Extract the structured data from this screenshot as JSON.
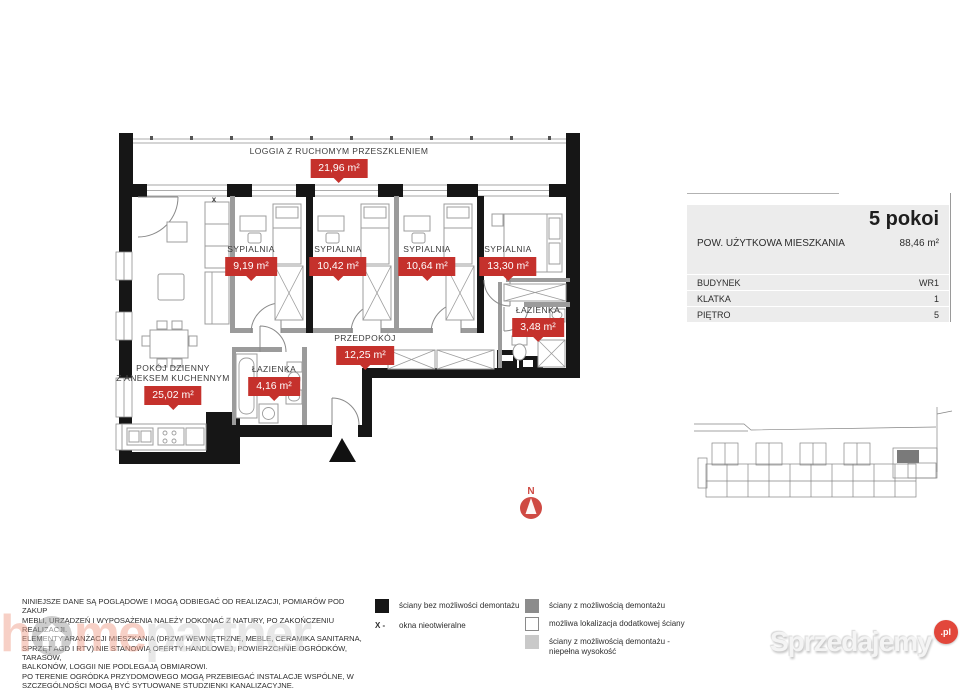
{
  "floor_plan": {
    "loggia": {
      "name": "LOGGIA Z RUCHOMYM PRZESZKLENIEM",
      "area": "21,96 m²"
    },
    "rooms": [
      {
        "id": "sypialnia-1",
        "name": "SYPIALNIA",
        "area": "9,19 m²"
      },
      {
        "id": "sypialnia-2",
        "name": "SYPIALNIA",
        "area": "10,42 m²"
      },
      {
        "id": "sypialnia-3",
        "name": "SYPIALNIA",
        "area": "10,64 m²"
      },
      {
        "id": "sypialnia-4",
        "name": "SYPIALNIA",
        "area": "13,30 m²"
      },
      {
        "id": "lazienka-1",
        "name": "ŁAZIENKA",
        "area": "3,48 m²"
      },
      {
        "id": "przedpokoj",
        "name": "PRZEDPOKÓJ",
        "area": "12,25 m²"
      },
      {
        "id": "lazienka-2",
        "name": "ŁAZIENKA",
        "area": "4,16 m²"
      },
      {
        "id": "pokoj-dzienny",
        "name": "POKÓJ DZIENNY\nZ ANEKSEM KUCHENNYM",
        "area": "25,02 m²"
      }
    ],
    "window_marker": "x",
    "compass": {
      "label": "N"
    }
  },
  "info_panel": {
    "title": "5 pokoi",
    "area_label": "POW. UŻYTKOWA MIESZKANIA",
    "area_value": "88,46 m²",
    "rows": [
      {
        "label": "BUDYNEK",
        "value": "WR1"
      },
      {
        "label": "KLATKA",
        "value": "1"
      },
      {
        "label": "PIĘTRO",
        "value": "5"
      }
    ]
  },
  "legend": {
    "left": [
      {
        "swatch_color": "#161616",
        "label": "ściany bez możliwości demontażu"
      },
      {
        "symbol": "X -",
        "label": "okna nieotwieralne"
      }
    ],
    "right": [
      {
        "swatch_color": "#8c8c8c",
        "label": "ściany z możliwością demontażu"
      },
      {
        "swatch_color": "#ffffff",
        "label": "możliwa lokalizacja dodatkowej ściany"
      },
      {
        "swatch_color": "#c9c9c9",
        "label": "ściany z możliwością demontażu -\nniepełna wysokość"
      }
    ]
  },
  "disclaimer": "NINIEJSZE DANE SĄ POGLĄDOWE I MOGĄ ODBIEGAĆ OD REALIZACJI, POMIARÓW POD ZAKUP\nMEBLI, URZĄDZEŃ I WYPOSAŻENIA NALEŻY DOKONAĆ Z NATURY, PO ZAKOŃCZENIU REALIZACJI.\nELEMENTY ARANŻACJI MIESZKANIA (DRZWI WEWNĘTRZNE, MEBLE, CERAMIKA SANITARNA,\nSPRZĘT AGD I RTV) NIE STANOWIĄ OFERTY HANDLOWEJ, POWIERZCHNIE OGRÓDKÓW, TARASÓW,\nBALKONÓW, LOGGII NIE PODLEGAJĄ OBMIAROWI.\nPO TERENIE OGRÓDKA PRZYDOMOWEGO MOGĄ PRZEBIEGAĆ INSTALACJE WSPÓLNE, W\nSZCZEGÓLNOŚCI MOGĄ BYĆ SYTUOWANE STUDZIENKI KANALIZACYJNE.",
  "logos": {
    "homepartner": {
      "part1": "h",
      "part2": "me",
      "part3": "partner"
    },
    "sprzedajemy": {
      "text": "Sprzedajemy",
      "badge": ".pl"
    }
  },
  "colors": {
    "label_red": "#c5312c",
    "wall_black": "#161616",
    "wall_gray": "#9b9b9b",
    "demolition_gray": "#8c8c8c",
    "half_height_gray": "#c9c9c9",
    "panel_bg": "#ececec",
    "compass_red": "#cf4a43",
    "logo_salmon": "#f0a38e",
    "logo_gray": "#d3d3d3",
    "sprzedajemy_red": "#e2473b"
  }
}
